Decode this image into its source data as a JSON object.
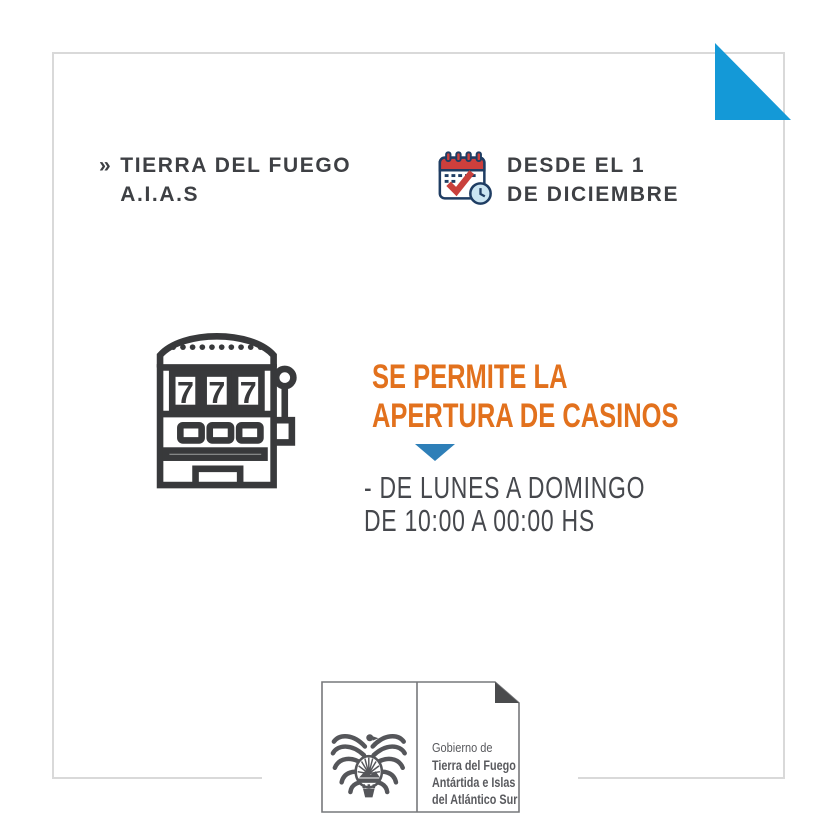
{
  "canvas": {
    "background": "#ffffff",
    "frame_color": "#d9d9d9",
    "corner_accent_color": "#1499d7"
  },
  "header": {
    "chevron": "»",
    "title_line1": "TIERRA DEL FUEGO",
    "title_line2": "A.I.A.S",
    "text_color": "#3e4044",
    "date": {
      "icon": "calendar-check-icon",
      "icon_colors": {
        "outline": "#1f3d63",
        "red": "#c9403c",
        "light_blue": "#cbe5f2"
      },
      "line1": "DESDE EL 1",
      "line2": "DE DICIEMBRE"
    }
  },
  "main": {
    "icon": "slot-machine-icon",
    "icon_color": "#38393b",
    "slot_reel_digit": "7",
    "headline_color": "#e2711d",
    "headline_line1": "SE PERMITE LA",
    "headline_line2": "APERTURA DE CASINOS",
    "pointer_icon": "triangle-down-icon",
    "pointer_color": "#2e7fb8",
    "schedule_color": "#46484d",
    "schedule_line1": "- DE LUNES A DOMINGO",
    "schedule_line2": "DE 10:00 A 00:00 HS"
  },
  "footer_logo": {
    "emblem_icon": "tierra-del-fuego-coat-of-arms-icon",
    "fold_icon": "page-fold-icon",
    "border_color": "#77787b",
    "text_color": "#595a5e",
    "org_line1": "Gobierno de",
    "org_line2": "Tierra del Fuego",
    "org_line3": "Antártida e Islas",
    "org_line4": "del Atlántico Sur"
  }
}
